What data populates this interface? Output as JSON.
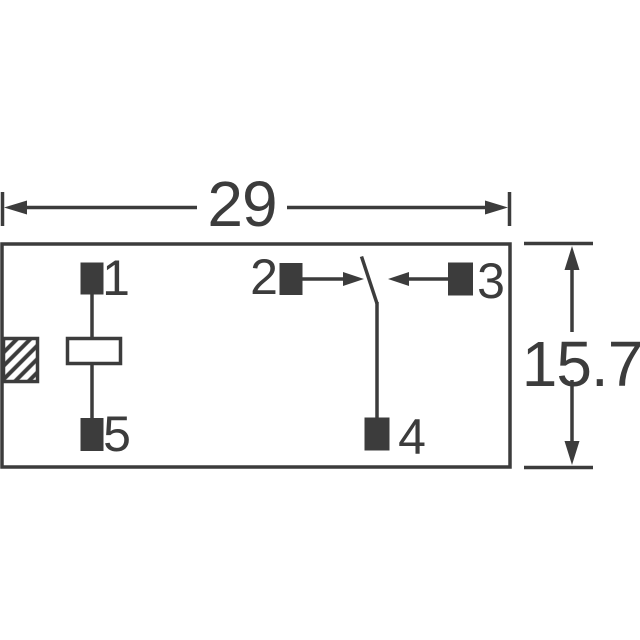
{
  "colors": {
    "ink": "#3c3c3c",
    "canvas": "#ffffff"
  },
  "dimensions": {
    "width_label": "29",
    "height_label": "15.7"
  },
  "pins": {
    "pin1": "1",
    "pin2": "2",
    "pin3": "3",
    "pin4": "4",
    "pin5": "5"
  }
}
